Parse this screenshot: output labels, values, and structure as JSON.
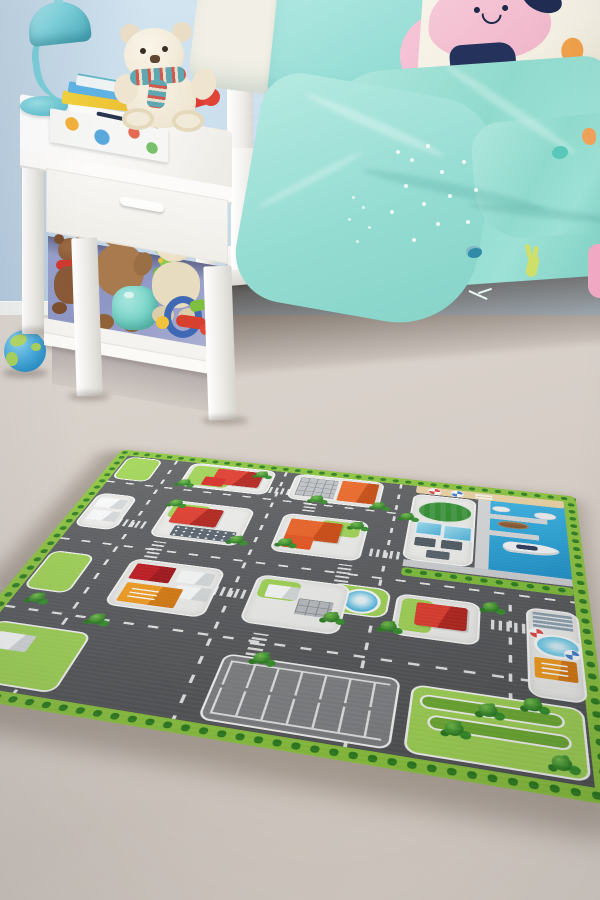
{
  "meta": {
    "type": "photograph",
    "setting": "children's bedroom with a city-road play rug",
    "width": 600,
    "height": 900
  },
  "palette": {
    "wall": "#c9dcea",
    "baseboard": "#eef0ee",
    "floor": "#d5cdc6",
    "floor-deep": "#cdc4bc",
    "white-furniture": "#f7f6f3",
    "cubby-glow": "#8d96c4",
    "lamp-teal": "#7ccfd9",
    "lamp-teal-deep": "#53b2c1",
    "sheet-teal": "#8edacd",
    "duvet-teal": "#a3e2d8",
    "duvet-shade": "#7accbf",
    "pillow-pink": "#f2bcd2",
    "pillow-navy": "#26335c",
    "pillow-cream": "#f4f0e4",
    "accent-orange": "#f0a04a",
    "bear-cream": "#f2ead8",
    "bear-brown": "#a87a4e",
    "bear-dark-brown": "#8a5a38",
    "bear-nose": "#5f4733",
    "toy-red": "#dd3b33",
    "toy-blue": "#3f69b5",
    "toy-yellow": "#f2c23c",
    "toy-green": "#7cc243",
    "toy-teal": "#74d2c6",
    "globe-blue": "#49aadb",
    "globe-land": "#b3d765",
    "rug-green": "#8dc63f",
    "bush-green": "#2e7f20",
    "grass-green": "#a2d656",
    "road-gray": "#5a5c5f",
    "plot-white": "#f1f1ef",
    "parking-gray": "#808285",
    "water-blue": "#2ba7dc",
    "sand": "#ecd3a4",
    "dock-gray": "#d8dadc",
    "roof-red": "#e23c2e",
    "roof-dark-red": "#a31318",
    "roof-orange": "#ef6325",
    "roof-amber": "#f59d1e",
    "roof-slate": "#5a6570",
    "roof-gray": "#c3c7ca",
    "field-green": "#2f8f2f",
    "pool-blue": "#5cc6ea",
    "glass-blue": "#4cb4dd",
    "shadow-brown": "#4a3c33"
  },
  "objects": {
    "scene_label": "Photo of a child's bedroom: white nightstand with teddy bears and toys, teal lamp, bed with turquoise animal-print bedding, blue globe ball, and a green-bordered city road play rug on a pale floor",
    "bed": {
      "label": "white bed with turquoise bedding",
      "pillows": [
        "white pillow",
        "turquoise pillow with pink animal-face patch and navy eye",
        "cream pillow with pink smiling character, navy patch and orange dot"
      ],
      "duvet_prints": [
        "white speckles",
        "teal bug",
        "yellow-green rabbit",
        "teal blob",
        "orange blob",
        "pink shape at edge"
      ]
    },
    "nightstand": {
      "label": "white bedside table with drawer and open shelf",
      "top_items": [
        "teal dome lamp",
        "stack of picture books",
        "open magazine",
        "dark pen",
        "red toy telephone",
        "white teddy bear with patterned scarf"
      ],
      "shelf_items": [
        "small dark-brown teddy with red scarf",
        "brown teddy bear",
        "teal ball",
        "cream teddy with orange cap",
        "colorful activity toy",
        "green caterpillar hanger"
      ]
    },
    "floor_toys": {
      "label": "globe-patterned ball"
    },
    "rug": {
      "label": "city road play rug with green bush border",
      "features": [
        "gray roads with white dashed lines",
        "zebra crosswalks",
        "red-roof houses",
        "orange buildings",
        "gray office with panel roof",
        "slate apartment with windows",
        "harbor with sandy beach and two parasols",
        "piers with four boats",
        "taxi on quay",
        "oval sports field",
        "blue glass buildings",
        "round fountain",
        "swimming pool with two parasols",
        "parking lot",
        "trees and hedges"
      ],
      "boats": 4,
      "parasols": 4
    }
  }
}
